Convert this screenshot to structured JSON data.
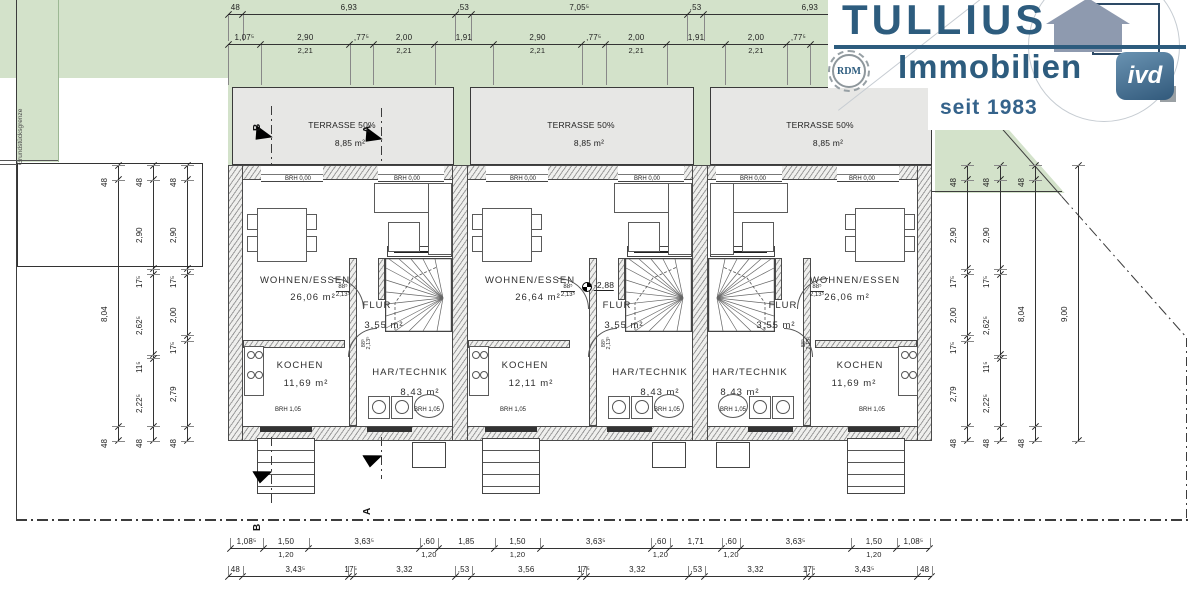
{
  "logo": {
    "brand": "TULLIUS",
    "line2": "Immobilien",
    "since": "seit 1983",
    "badge_rdm": "RDM",
    "badge_ivd": "ivd",
    "brand_color": "#2d5c7e",
    "house_color": "#8e9aaf"
  },
  "site": {
    "boundary": "Grundstücksgrenze"
  },
  "sections": [
    {
      "label": "B"
    },
    {
      "label": "A"
    }
  ],
  "units": [
    {
      "terrace_name": "TERRASSE 50%",
      "terrace_area": "8,85 m²",
      "wohnen": "WOHNEN/ESSEN",
      "wohnen_area": "26,06 m²",
      "flur": "FLUR",
      "flur_area": "3,55 m²",
      "kochen": "KOCHEN",
      "kochen_area": "11,69 m²",
      "technik": "HAR/TECHNIK",
      "technik_area": "8,43 m²",
      "brh_top": "BRH 0,00",
      "brh_bottom": "BRH 1,05",
      "door_w": "88⁵",
      "door_h": "2,13⁵"
    },
    {
      "terrace_name": "TERRASSE 50%",
      "terrace_area": "8,85 m²",
      "wohnen": "WOHNEN/ESSEN",
      "wohnen_area": "26,64 m²",
      "flur": "FLUR",
      "flur_area": "3,55 m²",
      "kochen": "KOCHEN",
      "kochen_area": "12,11 m²",
      "technik": "HAR/TECHNIK",
      "technik_area": "8,43 m²",
      "brh_top": "BRH 0,00",
      "brh_bottom": "BRH 1,05",
      "door_w": "88⁵",
      "door_h": "2,13⁵",
      "level": "-2,88"
    },
    {
      "terrace_name": "TERRASSE 50%",
      "terrace_area": "8,85 m²",
      "wohnen": "WOHNEN/ESSEN",
      "wohnen_area": "26,06 m²",
      "flur": "FLUR",
      "flur_area": "3,55 m²",
      "kochen": "KOCHEN",
      "kochen_area": "11,69 m²",
      "technik": "HAR/TECHNIK",
      "technik_area": "8,43 m²",
      "brh_top": "BRH 0,00",
      "brh_bottom": "BRH 1,05",
      "door_w": "88⁵",
      "door_h": "2,13⁵"
    }
  ],
  "dims": {
    "top1": [
      {
        "l": "48",
        "m": 0.48
      },
      {
        "l": "6,93",
        "m": 6.93
      },
      {
        "l": ",53",
        "m": 0.53
      },
      {
        "l": "7,05⁵",
        "m": 7.055
      },
      {
        "l": ",53",
        "m": 0.53
      },
      {
        "l": "6,93",
        "m": 6.93
      }
    ],
    "top2": [
      {
        "l": "1,07⁵",
        "m": 1.075
      },
      {
        "l": "2,90",
        "s": "2,21",
        "m": 2.9
      },
      {
        "l": ",77⁵",
        "m": 0.775
      },
      {
        "l": "2,00",
        "s": "2,21",
        "m": 2.0
      },
      {
        "l": "1,91",
        "m": 1.91
      },
      {
        "l": "2,90",
        "s": "2,21",
        "m": 2.9
      },
      {
        "l": ",77⁵",
        "m": 0.775
      },
      {
        "l": "2,00",
        "s": "2,21",
        "m": 2.0
      },
      {
        "l": "1,91",
        "m": 1.91
      },
      {
        "l": "2,00",
        "s": "2,21",
        "m": 2.0
      },
      {
        "l": ",77⁵",
        "m": 0.775
      },
      {
        "l": "2,90",
        "s": "2,21",
        "m": 2.9
      },
      {
        "l": "1,07⁵",
        "m": 1.075
      }
    ],
    "bottom1": [
      {
        "l": "1,08⁵",
        "m": 1.085
      },
      {
        "l": "1,50",
        "s": "1,20",
        "m": 1.5
      },
      {
        "l": "3,63⁵",
        "m": 3.635
      },
      {
        "l": ",60",
        "s": "1,20",
        "m": 0.6
      },
      {
        "l": "1,85",
        "m": 1.85
      },
      {
        "l": "1,50",
        "s": "1,20",
        "m": 1.5
      },
      {
        "l": "3,63⁵",
        "m": 3.635
      },
      {
        "l": ",60",
        "s": "1,20",
        "m": 0.6
      },
      {
        "l": "1,71",
        "m": 1.71
      },
      {
        "l": ",60",
        "s": "1,20",
        "m": 0.6
      },
      {
        "l": "3,63⁵",
        "m": 3.635
      },
      {
        "l": "1,50",
        "s": "1,20",
        "m": 1.5
      },
      {
        "l": "1,08⁵",
        "m": 1.085
      }
    ],
    "bottom2": [
      {
        "l": "48",
        "m": 0.48
      },
      {
        "l": "3,43⁵",
        "m": 3.435
      },
      {
        "l": "17⁵",
        "m": 0.175
      },
      {
        "l": "3,32",
        "m": 3.32
      },
      {
        "l": ",53",
        "m": 0.53
      },
      {
        "l": "3,56",
        "m": 3.56
      },
      {
        "l": "17⁵",
        "m": 0.175
      },
      {
        "l": "3,32",
        "m": 3.32
      },
      {
        "l": ",53",
        "m": 0.53
      },
      {
        "l": "3,32",
        "m": 3.32
      },
      {
        "l": "17⁵",
        "m": 0.175
      },
      {
        "l": "3,43⁵",
        "m": 3.435
      },
      {
        "l": "48",
        "m": 0.48
      }
    ],
    "left1": [
      {
        "l": "48",
        "m": 0.48
      },
      {
        "l": "8,04",
        "m": 8.04
      },
      {
        "l": "48",
        "m": 0.48
      }
    ],
    "left2": [
      {
        "l": "48",
        "m": 0.48
      },
      {
        "l": "2,90",
        "m": 2.9
      },
      {
        "l": "17⁵",
        "m": 0.175
      },
      {
        "l": "2,62⁵",
        "m": 2.625
      },
      {
        "l": "11⁵",
        "m": 0.115
      },
      {
        "l": "2,22⁵",
        "m": 2.225
      },
      {
        "l": "48",
        "m": 0.48
      }
    ],
    "left3": [
      {
        "l": "48",
        "m": 0.48
      },
      {
        "l": "2,90",
        "m": 2.9
      },
      {
        "l": "17⁵",
        "m": 0.175
      },
      {
        "l": "2,00",
        "m": 2.0
      },
      {
        "l": "17⁵",
        "m": 0.175
      },
      {
        "l": "2,79",
        "m": 2.79
      },
      {
        "l": "48",
        "m": 0.48
      }
    ],
    "right1": [
      {
        "l": "48",
        "m": 0.48
      },
      {
        "l": "2,90",
        "m": 2.9
      },
      {
        "l": "17⁵",
        "m": 0.175
      },
      {
        "l": "2,00",
        "m": 2.0
      },
      {
        "l": "17⁵",
        "m": 0.175
      },
      {
        "l": "2,79",
        "m": 2.79
      },
      {
        "l": "48",
        "m": 0.48
      }
    ],
    "right2": [
      {
        "l": "48",
        "m": 0.48
      },
      {
        "l": "2,90",
        "m": 2.9
      },
      {
        "l": "17⁵",
        "m": 0.175
      },
      {
        "l": "2,62⁵",
        "m": 2.625
      },
      {
        "l": "11⁵",
        "m": 0.115
      },
      {
        "l": "2,22⁵",
        "m": 2.225
      },
      {
        "l": "48",
        "m": 0.48
      }
    ],
    "right3": [
      {
        "l": "48",
        "m": 0.48
      },
      {
        "l": "8,04",
        "m": 8.04
      },
      {
        "l": "48",
        "m": 0.48
      }
    ],
    "right4": [
      {
        "l": "9,00",
        "m": 9.0
      }
    ]
  }
}
